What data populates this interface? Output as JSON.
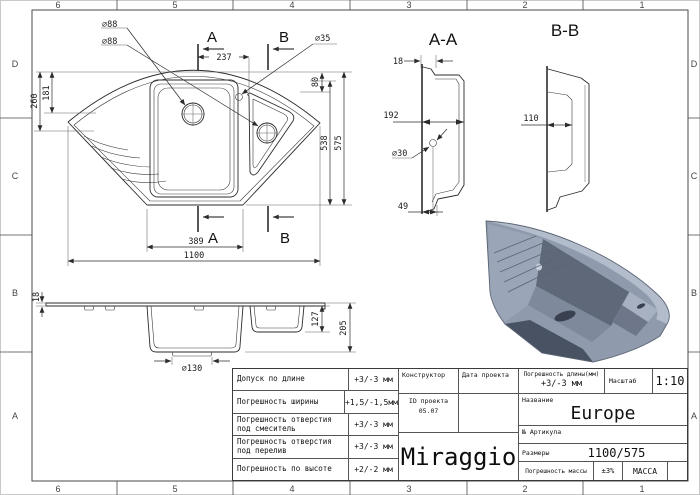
{
  "border": {
    "columns": [
      "6",
      "5",
      "4",
      "3",
      "2",
      "1"
    ],
    "rows": [
      "D",
      "C",
      "B",
      "A"
    ]
  },
  "plan_view": {
    "section_marker_a": "A",
    "section_marker_b": "B",
    "dims": {
      "drain_main": "⌀88",
      "drain_small": "⌀88",
      "overflow": "⌀35",
      "tap_offset": "237",
      "edge_offset": "80",
      "left_outer": "260",
      "left_inner": "181",
      "depth_inner": "538",
      "depth_overall": "575",
      "bottom_width": "389",
      "overall_width": "1100"
    }
  },
  "section_aa": {
    "title": "A-A",
    "dims": {
      "flange": "18",
      "width": "192",
      "hole": "⌀30",
      "foot": "49"
    }
  },
  "section_bb": {
    "title": "B-B",
    "dims": {
      "width": "110"
    }
  },
  "side_view": {
    "dims": {
      "rim": "18",
      "small_depth": "127",
      "overall_depth": "205",
      "drain": "⌀130"
    }
  },
  "render_colors": {
    "mid": "#8f9aad",
    "light_band": "#b3bcca",
    "wing": "#9aa5b7",
    "dark_wall": "#5e6879",
    "floor": "#7e8a9c",
    "hole": "#39404f",
    "underside": "#495263",
    "ledge": "#a7b1c1",
    "small_interior": "#6d7789",
    "edge_line": "#5a6474",
    "mount_hole": "#c9d0db"
  },
  "title_block": {
    "tolerances": [
      {
        "label": "Допуск по длине",
        "value": "+3/-3 мм"
      },
      {
        "label": "Погрешность ширины",
        "value": "+1,5/-1,5мм"
      },
      {
        "label": "Погрешность отверстия\nпод смеситель",
        "value": "+3/-3 мм"
      },
      {
        "label": "Погрешность отверстия\nпод перелив",
        "value": "+3/-3 мм"
      },
      {
        "label": "Погрешность по высоте",
        "value": "+2/-2 мм"
      }
    ],
    "constructor_label": "Конструктор",
    "date_label": "Дата проекта",
    "project_id_label": "ID проекта",
    "project_id_value": "05.07",
    "logo": "Miraggio",
    "length_tol_label": "Погрешность длины(мм)",
    "length_tol_value": "+3/-3 мм",
    "scale_label": "Масштаб",
    "scale_value": "1:10",
    "name_label": "Название",
    "name_value": "Europe",
    "article_label": "№ Артикула",
    "size_label": "Размеры",
    "size_value": "1100/575",
    "mass_tol_label": "Погрешность массы",
    "mass_tol_value": "±3%",
    "mass_label": "МАССА"
  }
}
